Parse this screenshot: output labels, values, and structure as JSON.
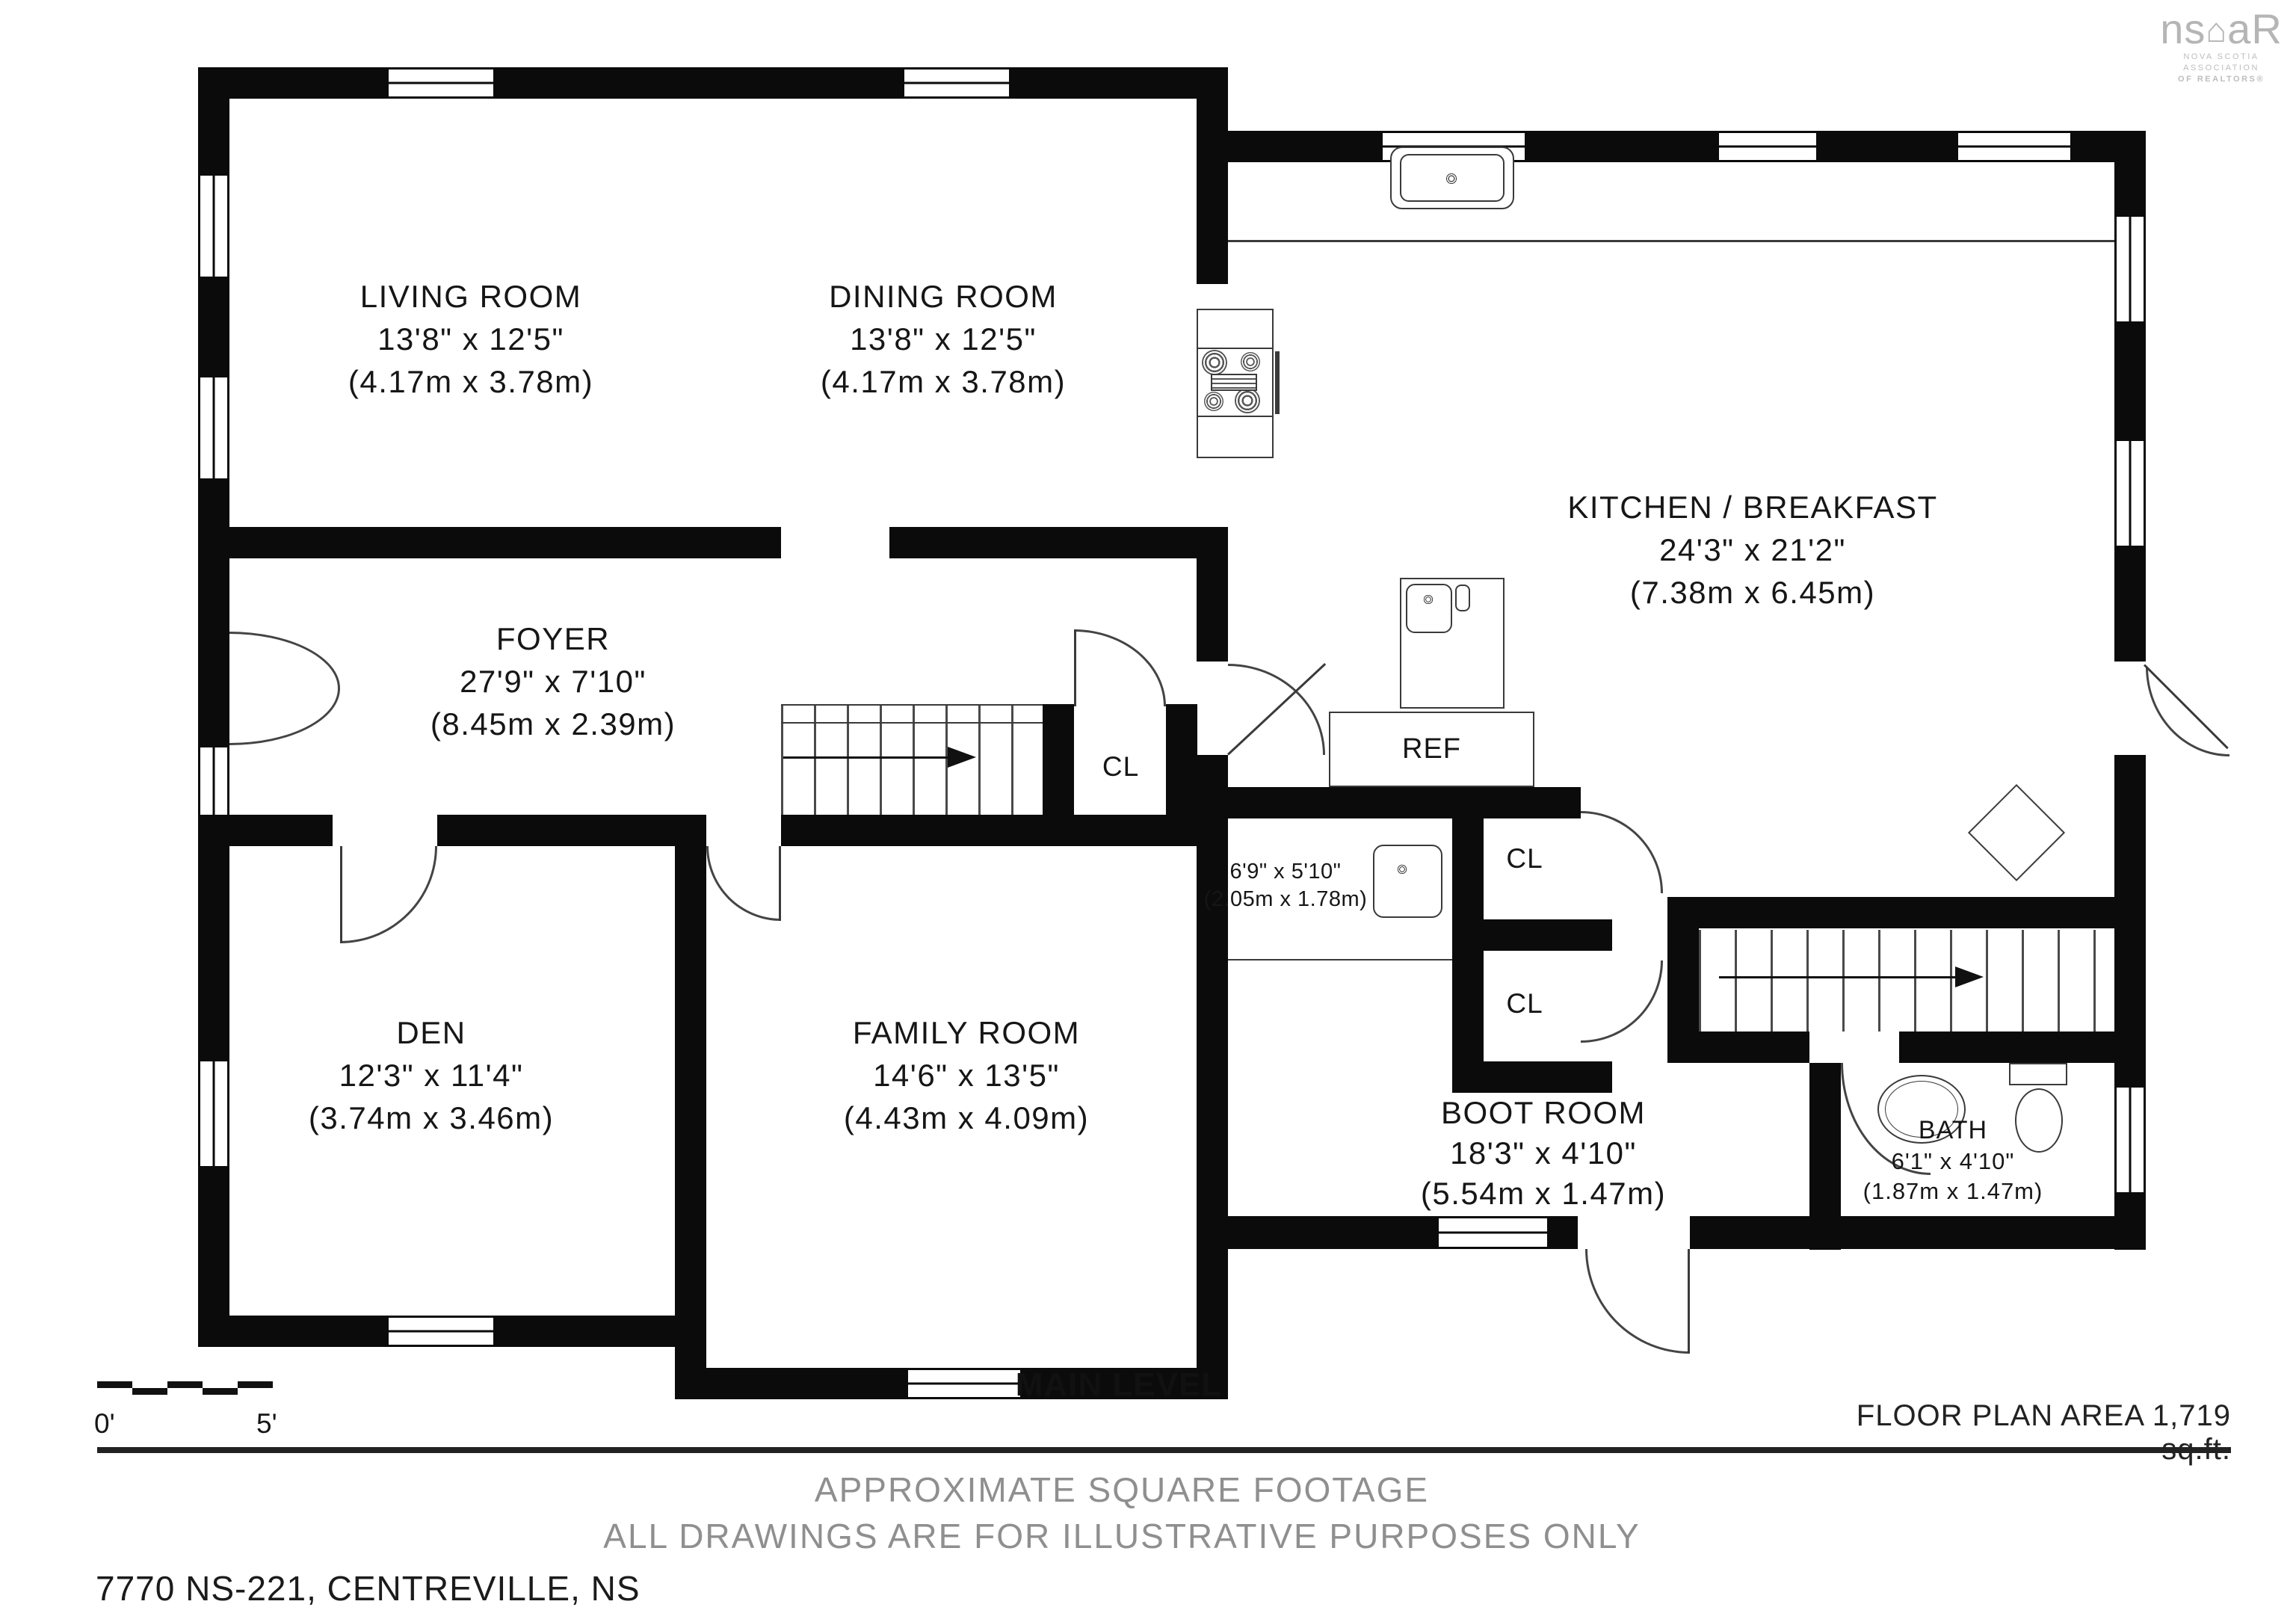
{
  "meta": {
    "level": "MAIN LEVEL",
    "area": "FLOOR PLAN AREA 1,719 sq.ft.",
    "footer_line1": "APPROXIMATE SQUARE FOOTAGE",
    "footer_line2": "ALL DRAWINGS ARE FOR ILLUSTRATIVE PURPOSES ONLY",
    "address": "7770 NS-221, CENTREVILLE, NS",
    "scale_start": "0'",
    "scale_end": "5'"
  },
  "logo": {
    "text_left": "ns",
    "text_right": "aR",
    "tagline_line1": "NOVA SCOTIA ASSOCIATION",
    "tagline_line2": "OF REALTORS®"
  },
  "rooms": {
    "living": {
      "name": "LIVING ROOM",
      "imperial": "13'8\" x 12'5\"",
      "metric": "(4.17m x 3.78m)"
    },
    "dining": {
      "name": "DINING ROOM",
      "imperial": "13'8\" x 12'5\"",
      "metric": "(4.17m x 3.78m)"
    },
    "kitchen": {
      "name": "KITCHEN / BREAKFAST",
      "imperial": "24'3\" x 21'2\"",
      "metric": "(7.38m x 6.45m)"
    },
    "foyer": {
      "name": "FOYER",
      "imperial": "27'9\" x 7'10\"",
      "metric": "(8.45m x 2.39m)"
    },
    "den": {
      "name": "DEN",
      "imperial": "12'3\" x 11'4\"",
      "metric": "(3.74m x 3.46m)"
    },
    "family": {
      "name": "FAMILY ROOM",
      "imperial": "14'6\" x 13'5\"",
      "metric": "(4.43m x 4.09m)"
    },
    "boot": {
      "name": "BOOT ROOM",
      "imperial": "18'3\" x 4'10\"",
      "metric": "(5.54m x 1.47m)"
    },
    "bath": {
      "name": "BATH",
      "imperial": "6'1\" x 4'10\"",
      "metric": "(1.87m x 1.47m)"
    },
    "utility": {
      "imperial": "6'9\" x 5'10\"",
      "metric": "(2.05m x 1.78m)"
    }
  },
  "fixtures": {
    "fridge": "REF",
    "closet1": "CL",
    "closet2": "CL",
    "closet3": "CL"
  }
}
